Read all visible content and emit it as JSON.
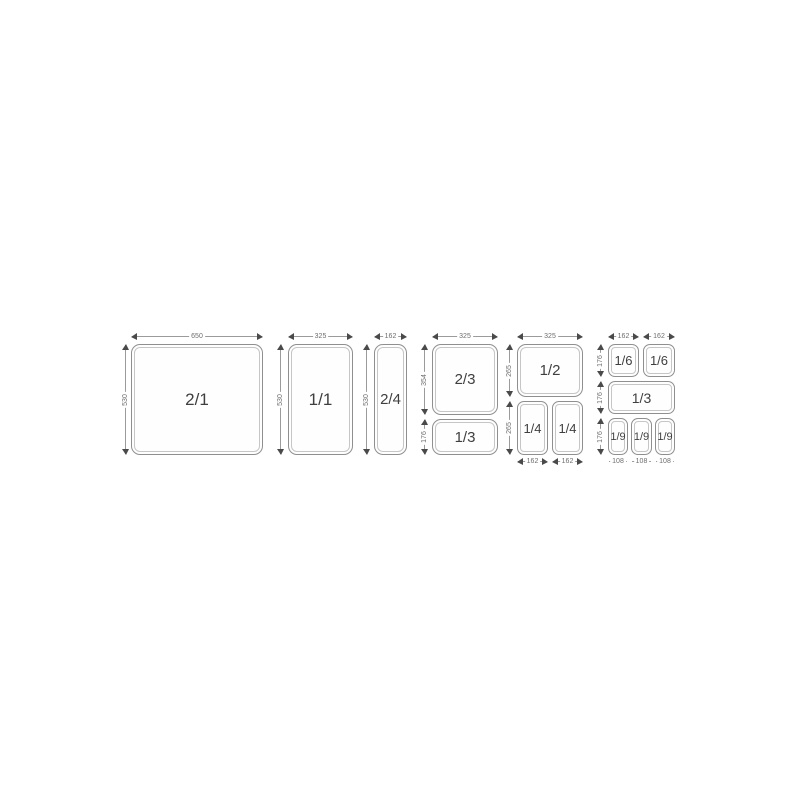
{
  "diagram": {
    "groups": [
      {
        "pans": [
          "2/1"
        ],
        "top_dims": [
          "650"
        ],
        "left_dims": [
          "530"
        ],
        "bottom_dims": []
      },
      {
        "pans": [
          "1/1"
        ],
        "top_dims": [
          "325"
        ],
        "left_dims": [
          "530"
        ],
        "bottom_dims": []
      },
      {
        "pans": [
          "2/4"
        ],
        "top_dims": [
          "162"
        ],
        "left_dims": [
          "530"
        ],
        "bottom_dims": []
      },
      {
        "pans": [
          "2/3",
          "1/3"
        ],
        "top_dims": [
          "325"
        ],
        "left_dims": [
          "354",
          "176"
        ],
        "bottom_dims": []
      },
      {
        "pans": [
          "1/2",
          "1/4",
          "1/4"
        ],
        "top_dims": [
          "325"
        ],
        "left_dims": [
          "265",
          "265"
        ],
        "bottom_dims": [
          "162",
          "162"
        ]
      },
      {
        "pans": [
          "1/6",
          "1/6",
          "1/3",
          "1/9",
          "1/9",
          "1/9"
        ],
        "top_dims": [
          "162",
          "162"
        ],
        "left_dims": [
          "176",
          "176",
          "176"
        ],
        "bottom_dims": [
          "108",
          "108",
          "108"
        ]
      }
    ],
    "colors": {
      "background": "#ffffff",
      "pan_outline": "#8f8f8f",
      "pan_inner_rim": "#c6c6c6",
      "pan_text": "#3f3f3f",
      "dim_line": "#9b9b9b",
      "dim_arrow": "#4a4a4a",
      "dim_text": "#6e6e6e"
    }
  }
}
